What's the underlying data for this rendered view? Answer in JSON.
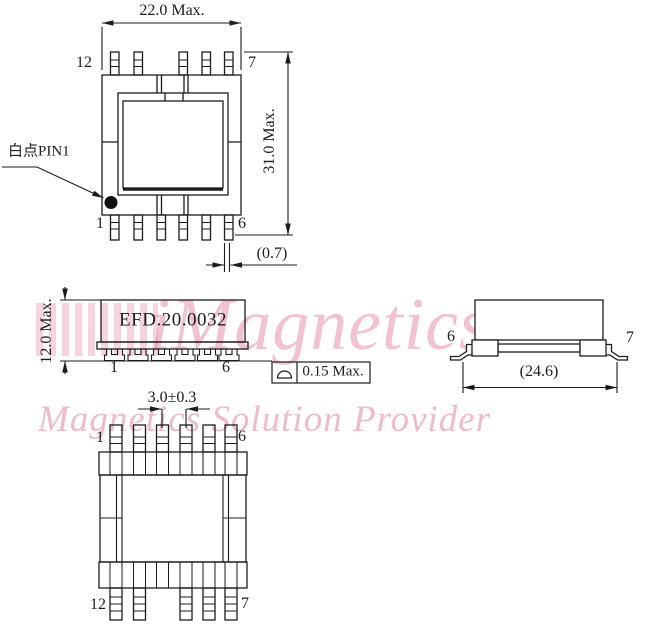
{
  "drawing": {
    "views": {
      "top": {
        "dim_width": "22.0 Max.",
        "dim_height": "31.0 Max.",
        "dim_lead_width": "(0.7)",
        "pin_top_left": "12",
        "pin_top_right": "7",
        "pin_bottom_left": "1",
        "pin_bottom_right": "6",
        "pin1_note": "白点PIN1"
      },
      "front": {
        "part_number": "EFD.20.0032",
        "dim_height": "12.0 Max.",
        "pin_left": "1",
        "pin_right": "6",
        "coplanarity": "0.15 Max."
      },
      "side": {
        "pin_left": "6",
        "pin_right": "7",
        "dim_width": "(24.6)"
      },
      "bottom": {
        "dim_pitch": "3.0±0.3",
        "pin_top_left": "1",
        "pin_top_right": "6",
        "pin_bottom_left": "12",
        "pin_bottom_right": "7"
      }
    },
    "watermark": {
      "brand": "iMagnetics",
      "tagline": "Magnetics Solution Provider"
    },
    "colors": {
      "line": "#1c1c1c",
      "watermark_pink": "#e26e8c",
      "background": "#ffffff"
    }
  }
}
